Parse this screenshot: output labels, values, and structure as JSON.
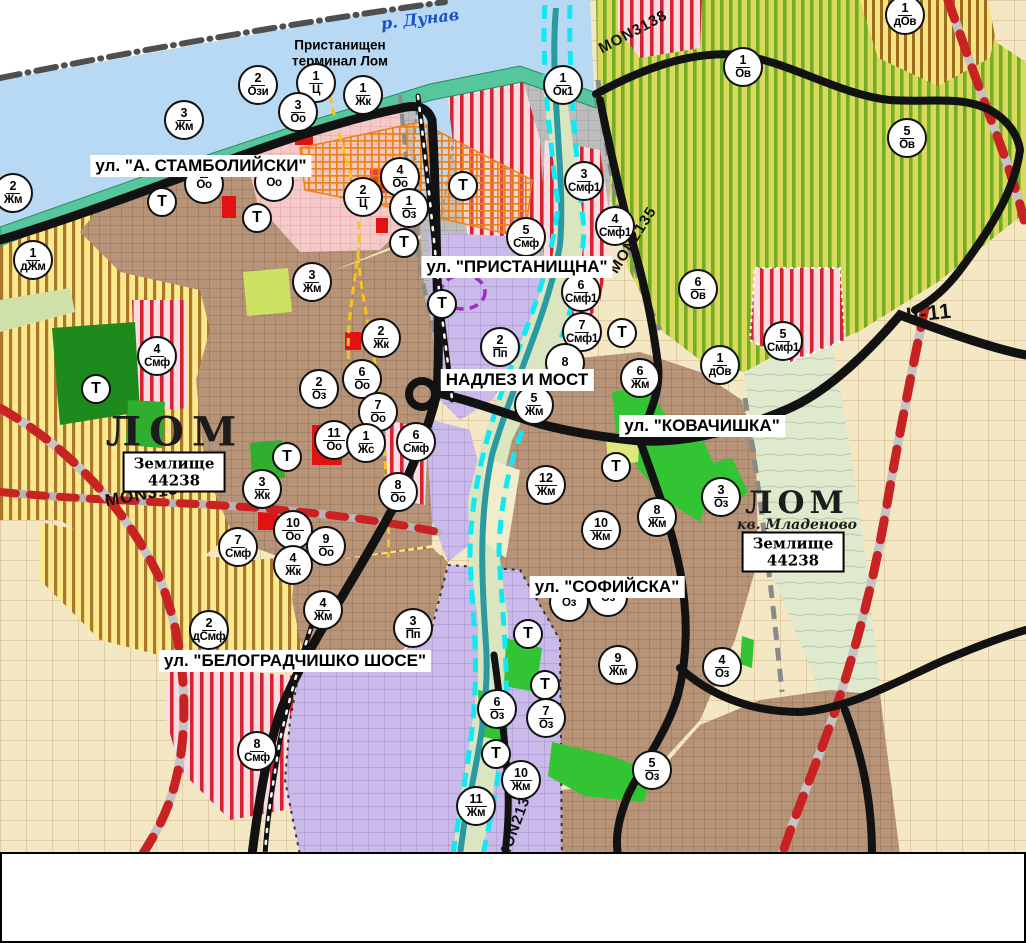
{
  "map": {
    "river_label": "р. Дунав",
    "port_label": "Пристанищен терминал Лом",
    "street_labels": [
      {
        "text": "ул. \"А. СТАМБОЛИЙСКИ\"",
        "x": 201,
        "y": 166
      },
      {
        "text": "ул. \"ПРИСТАНИЩНА\"",
        "x": 517,
        "y": 267
      },
      {
        "text": "НАДЛЕЗ И МОСТ",
        "x": 517,
        "y": 380
      },
      {
        "text": "ул. \"КОВАЧИШКА\"",
        "x": 702,
        "y": 426
      },
      {
        "text": "ул. \"СОФИЙСКА\"",
        "x": 607,
        "y": 587
      },
      {
        "text": "ул. \"БЕЛОГРАДЧИШКО ШОСЕ\"",
        "x": 295,
        "y": 661
      }
    ],
    "road_labels": [
      {
        "text": "MON3138",
        "x": 633,
        "y": 32,
        "rot": -28,
        "size": 15
      },
      {
        "text": "MON2135",
        "x": 633,
        "y": 240,
        "rot": -58,
        "size": 15
      },
      {
        "text": "MON3139",
        "x": 147,
        "y": 494,
        "rot": -10,
        "size": 17
      },
      {
        "text": "MON2136",
        "x": 516,
        "y": 824,
        "rot": -70,
        "size": 15
      },
      {
        "text": "II-11",
        "x": 929,
        "y": 314,
        "rot": -6,
        "size": 21
      }
    ],
    "place_labels": [
      {
        "text": "ЛОМ",
        "x": 175,
        "y": 432,
        "size": 40,
        "ls": 8
      },
      {
        "text": "ЛОМ",
        "x": 797,
        "y": 503,
        "size": 31,
        "ls": 5
      }
    ],
    "district_labels": [
      {
        "text": "кв. Младеново",
        "x": 797,
        "y": 525
      }
    ],
    "area_boxes": [
      {
        "label": "Землище",
        "code": "44238",
        "x": 174,
        "y": 472
      },
      {
        "label": "Землище",
        "code": "44238",
        "x": 793,
        "y": 552
      }
    ],
    "zone_markers": [
      {
        "num": "3",
        "abbr": "Жм",
        "x": 184,
        "y": 120
      },
      {
        "num": "2",
        "abbr": "Ози",
        "x": 258,
        "y": 85
      },
      {
        "num": "1",
        "abbr": "Ц",
        "x": 316,
        "y": 83
      },
      {
        "num": "3",
        "abbr": "Оо",
        "x": 298,
        "y": 112
      },
      {
        "num": "1",
        "abbr": "Жк",
        "x": 363,
        "y": 95
      },
      {
        "num": "4",
        "abbr": "Оо",
        "x": 400,
        "y": 177
      },
      {
        "num": "2",
        "abbr": "Ц",
        "x": 363,
        "y": 197
      },
      {
        "num": "1",
        "abbr": "Оз",
        "x": 409,
        "y": 208
      },
      {
        "num": "1",
        "abbr": "Ок1",
        "x": 563,
        "y": 85
      },
      {
        "num": "3",
        "abbr": "Смф1",
        "x": 584,
        "y": 181
      },
      {
        "num": "2",
        "abbr": "Жм",
        "x": 13,
        "y": 193
      },
      {
        "num": "1",
        "abbr": "дЖм",
        "x": 33,
        "y": 260
      },
      {
        "num": "3",
        "abbr": "Жм",
        "x": 312,
        "y": 282
      },
      {
        "num": "4",
        "abbr": "Смф1",
        "x": 615,
        "y": 226
      },
      {
        "num": "5",
        "abbr": "Смф",
        "x": 526,
        "y": 237
      },
      {
        "num": "6",
        "abbr": "Смф1",
        "x": 581,
        "y": 292
      },
      {
        "num": "7",
        "abbr": "Смф1",
        "x": 582,
        "y": 332
      },
      {
        "num": "6",
        "abbr": "Ов",
        "x": 698,
        "y": 289
      },
      {
        "num": "5",
        "abbr": "Смф1",
        "x": 783,
        "y": 341
      },
      {
        "num": "1",
        "abbr": "дОв",
        "x": 720,
        "y": 365
      },
      {
        "num": "8",
        "abbr": "",
        "x": 565,
        "y": 363
      },
      {
        "num": "1",
        "abbr": "Ов",
        "x": 743,
        "y": 67
      },
      {
        "num": "5",
        "abbr": "Ов",
        "x": 907,
        "y": 138
      },
      {
        "num": "1",
        "abbr": "дОв",
        "x": 905,
        "y": 15
      },
      {
        "num": "2",
        "abbr": "Пп",
        "x": 500,
        "y": 347
      },
      {
        "num": "2",
        "abbr": "Жк",
        "x": 381,
        "y": 338
      },
      {
        "num": "6",
        "abbr": "Оо",
        "x": 362,
        "y": 379
      },
      {
        "num": "2",
        "abbr": "Оз",
        "x": 319,
        "y": 389
      },
      {
        "num": "7",
        "abbr": "Оо",
        "x": 378,
        "y": 412
      },
      {
        "num": "11",
        "abbr": "Оо",
        "x": 334,
        "y": 440
      },
      {
        "num": "1",
        "abbr": "Жс",
        "x": 366,
        "y": 443
      },
      {
        "num": "6",
        "abbr": "Смф",
        "x": 416,
        "y": 442
      },
      {
        "num": "8",
        "abbr": "Оо",
        "x": 398,
        "y": 492
      },
      {
        "num": "3",
        "abbr": "Жк",
        "x": 262,
        "y": 489
      },
      {
        "num": "10",
        "abbr": "Оо",
        "x": 293,
        "y": 530
      },
      {
        "num": "9",
        "abbr": "Оо",
        "x": 326,
        "y": 546
      },
      {
        "num": "7",
        "abbr": "Смф",
        "x": 238,
        "y": 547
      },
      {
        "num": "4",
        "abbr": "Жк",
        "x": 293,
        "y": 565
      },
      {
        "num": "4",
        "abbr": "Смф",
        "x": 157,
        "y": 356
      },
      {
        "num": "5",
        "abbr": "Жм",
        "x": 534,
        "y": 405
      },
      {
        "num": "12",
        "abbr": "Жм",
        "x": 546,
        "y": 485
      },
      {
        "num": "10",
        "abbr": "Жм",
        "x": 601,
        "y": 530
      },
      {
        "num": "8",
        "abbr": "Жм",
        "x": 657,
        "y": 517
      },
      {
        "num": "6",
        "abbr": "Жм",
        "x": 640,
        "y": 378
      },
      {
        "num": "3",
        "abbr": "Оз",
        "x": 721,
        "y": 497
      },
      {
        "num": "4",
        "abbr": "Оз",
        "x": 722,
        "y": 667
      },
      {
        "num": "9",
        "abbr": "Жм",
        "x": 618,
        "y": 665
      },
      {
        "num": "",
        "abbr": "Оз",
        "x": 569,
        "y": 602
      },
      {
        "num": "",
        "abbr": "Оз",
        "x": 608,
        "y": 597
      },
      {
        "num": "6",
        "abbr": "Оз",
        "x": 497,
        "y": 709
      },
      {
        "num": "7",
        "abbr": "Оз",
        "x": 546,
        "y": 718
      },
      {
        "num": "10",
        "abbr": "Жм",
        "x": 521,
        "y": 780
      },
      {
        "num": "11",
        "abbr": "Жм",
        "x": 476,
        "y": 806
      },
      {
        "num": "5",
        "abbr": "Оз",
        "x": 652,
        "y": 770
      },
      {
        "num": "2",
        "abbr": "дСмф",
        "x": 209,
        "y": 630
      },
      {
        "num": "4",
        "abbr": "Жм",
        "x": 323,
        "y": 610
      },
      {
        "num": "3",
        "abbr": "Пп",
        "x": 413,
        "y": 628
      },
      {
        "num": "8",
        "abbr": "Смф",
        "x": 257,
        "y": 751
      },
      {
        "num": "",
        "abbr": "Оо",
        "x": 204,
        "y": 184
      },
      {
        "num": "",
        "abbr": "Оо",
        "x": 274,
        "y": 182
      }
    ],
    "t_markers": [
      {
        "x": 162,
        "y": 202
      },
      {
        "x": 257,
        "y": 218
      },
      {
        "x": 404,
        "y": 243
      },
      {
        "x": 463,
        "y": 186
      },
      {
        "x": 442,
        "y": 304
      },
      {
        "x": 287,
        "y": 457
      },
      {
        "x": 96,
        "y": 389
      },
      {
        "x": 622,
        "y": 333
      },
      {
        "x": 616,
        "y": 467
      },
      {
        "x": 528,
        "y": 634
      },
      {
        "x": 545,
        "y": 685
      },
      {
        "x": 496,
        "y": 754
      }
    ],
    "icon_markers": [
      {
        "type": "monument-orange",
        "x": 240,
        "y": 139
      },
      {
        "type": "monument-orange",
        "x": 350,
        "y": 141
      },
      {
        "type": "monument-orange",
        "x": 380,
        "y": 223
      },
      {
        "type": "monument-orange",
        "x": 372,
        "y": 277
      },
      {
        "type": "monument-orange",
        "x": 342,
        "y": 320
      },
      {
        "type": "monument-orange",
        "x": 368,
        "y": 487
      },
      {
        "type": "monument-orange",
        "x": 629,
        "y": 634
      },
      {
        "type": "monument-green",
        "x": 397,
        "y": 80
      },
      {
        "type": "monument-green",
        "x": 322,
        "y": 151
      },
      {
        "type": "monument-green",
        "x": 308,
        "y": 190
      },
      {
        "type": "mask-blue",
        "x": 393,
        "y": 468
      },
      {
        "type": "mask-blue",
        "x": 664,
        "y": 624
      },
      {
        "type": "arrow-black",
        "x": 267,
        "y": 131
      },
      {
        "type": "person-black",
        "x": 338,
        "y": 181
      },
      {
        "type": "tunnel-black",
        "x": 293,
        "y": 207
      },
      {
        "type": "anchor-white",
        "x": 482,
        "y": 162
      },
      {
        "type": "fan-white",
        "x": 526,
        "y": 83
      },
      {
        "type": "warning-yellow",
        "x": 490,
        "y": 291
      },
      {
        "type": "truck-white",
        "x": 443,
        "y": 334
      },
      {
        "type": "lightning-black",
        "x": 283,
        "y": 694
      },
      {
        "type": "lightning-black",
        "x": 268,
        "y": 784
      }
    ],
    "dot_markers": [
      {
        "kind": "red",
        "x": 120,
        "y": 139
      },
      {
        "kind": "red",
        "x": 103,
        "y": 193
      },
      {
        "kind": "red",
        "x": 42,
        "y": 206
      },
      {
        "kind": "red",
        "x": 656,
        "y": 459
      },
      {
        "kind": "red",
        "x": 569,
        "y": 543
      },
      {
        "kind": "red",
        "x": 477,
        "y": 762
      },
      {
        "kind": "red",
        "x": 768,
        "y": 618
      },
      {
        "kind": "blue",
        "x": 285,
        "y": 87
      }
    ],
    "icon_styles": {
      "monument-orange": {
        "bg": "#e8821e",
        "glyph": "#3f2300"
      },
      "monument-green": {
        "bg": "#2fbe2f",
        "glyph": "#073a07"
      },
      "mask-blue": {
        "bg": "#7b98e0",
        "glyph": "#14297e"
      },
      "arrow-black": {
        "bg": "#111111",
        "glyph": "#ffffff"
      },
      "person-black": {
        "bg": "#111111",
        "glyph": "#ffffff"
      },
      "tunnel-black": {
        "bg": "#111111",
        "glyph": "#ffffff"
      },
      "anchor-white": {
        "bg": "#ffffff",
        "glyph": "#111111"
      },
      "fan-white": {
        "bg": "#ffffff",
        "glyph": "#111111"
      },
      "warning-yellow": {
        "bg": "#f2c718",
        "glyph": "#111111"
      },
      "truck-white": {
        "bg": "#ffffff",
        "glyph": "#111111"
      },
      "lightning-black": {
        "bg": "#111111",
        "glyph": "#ffffff"
      }
    },
    "colors": {
      "water": "#b7d9f4",
      "shore": "#56c69c",
      "road_black": "#121212",
      "state_road_dash": "#c82222",
      "cyan_river": "#10e8f4",
      "river_core": "#2a9aa2",
      "marker_border": "#111111",
      "red_dot": "#e02020",
      "blue_ring": "#2244cc",
      "boundary_yellow": "#f6c516",
      "heritage_orange": "#e8821e",
      "border_line": "#4f4f4f"
    }
  },
  "footer": {
    "runs": [
      {
        "b": true,
        "t": "ОБОЗНАЧЕНИТЕ НА КАРТАТА УЛИЦИ: „АЛЕКСАНДЪР СТАМБОЛИЙСКИ“"
      },
      {
        "b": false,
        "t": " - част от Републикански път (РП) II-11, "
      },
      {
        "b": true,
        "t": "„ПРИСТАНИЩНА“"
      },
      {
        "b": false,
        "t": " – част от РП II-11, "
      },
      {
        "b": true,
        "t": "НАДЛЕЗ И МОСТ НАД РЕКА ЛОМ"
      },
      {
        "b": false,
        "t": " – част от РП II-11, "
      },
      {
        "b": true,
        "t": "„СОФИЙСКА“"
      },
      {
        "b": false,
        "t": " – част от РП II-81, "
      },
      {
        "b": true,
        "t": "„КОВАЧИШКА“"
      },
      {
        "b": false,
        "t": " – част от РП II-11, "
      },
      {
        "b": true,
        "t": "„БЕЛОГРАДЧИШКО ШОСЕ“"
      },
      {
        "b": false,
        "t": " – част от РП III-114, "
      },
      {
        "b": true,
        "t": "СА СОБСТВЕНОСТ НА АГЕНЦИЯ „ПЪТНА ИНФРАСТРУКТУРА“ (АПИ), КОЯТО ОТГОВАРЯ ЗА ТЯХНОТО ТЕКУЩО ПОДДЪРЖАНЕ, ОСНОВНИ РЕМОНТИ И РАЗРЕШИТЕЛНИ РЕЖИМИ."
      }
    ]
  }
}
